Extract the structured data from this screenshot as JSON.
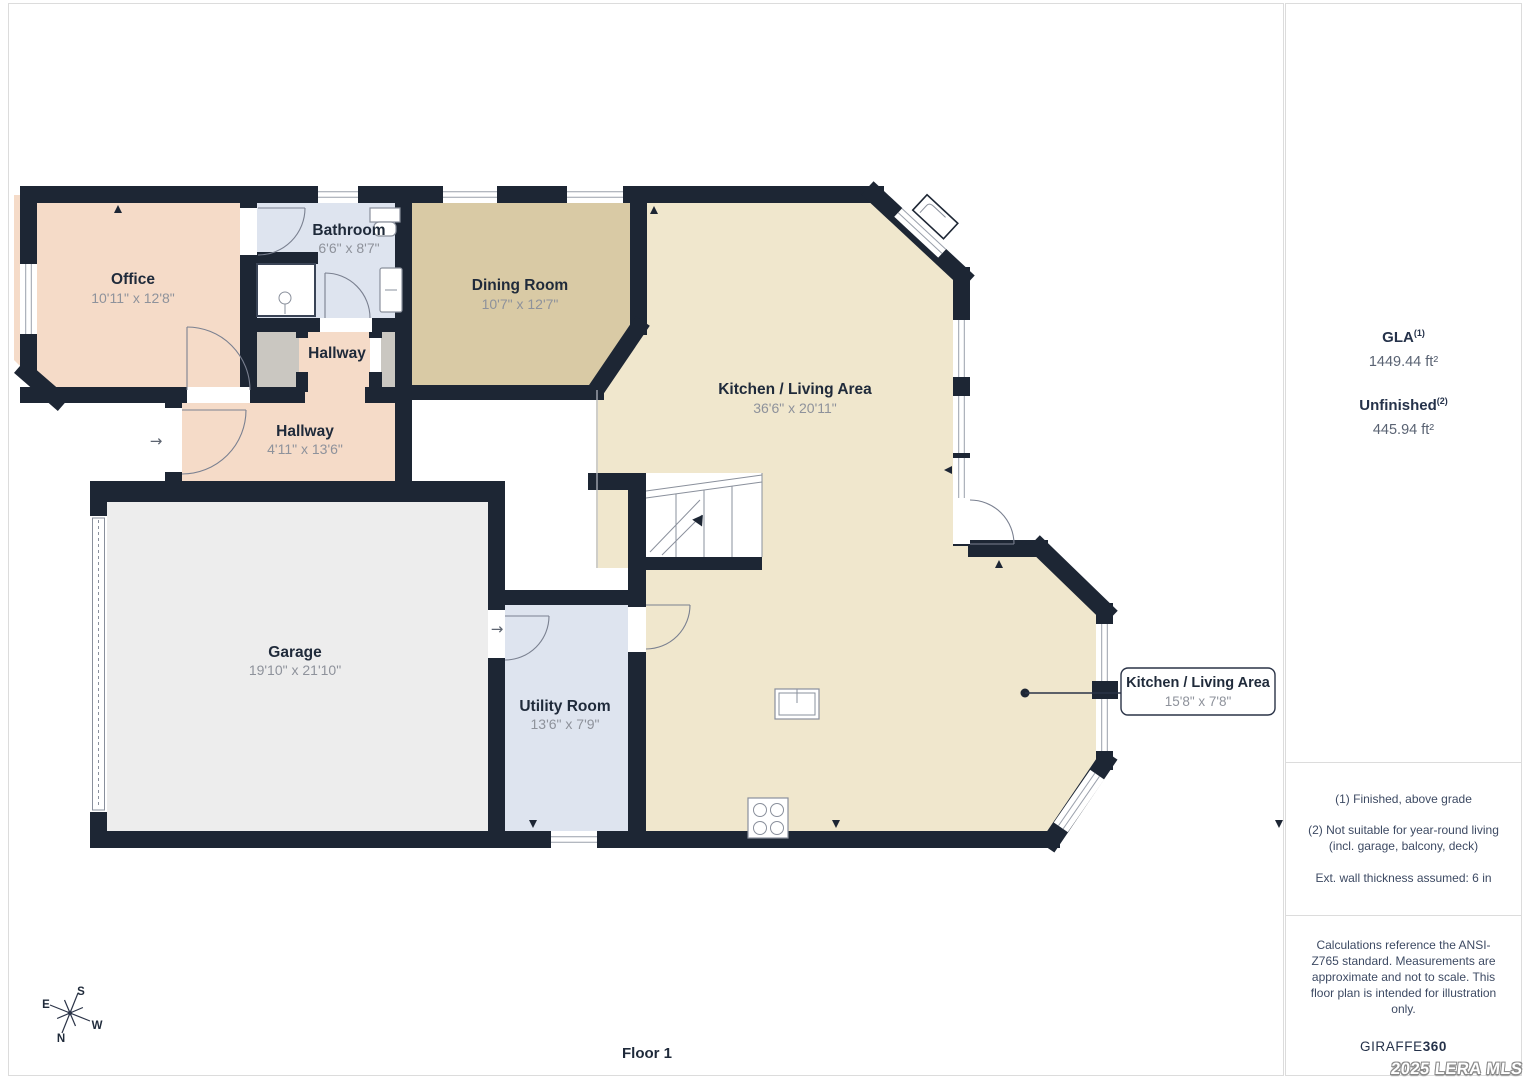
{
  "colors": {
    "wall": "#1d2634",
    "floor_pink": "#f5dbc8",
    "floor_blue": "#dee4ef",
    "floor_grey": "#cac7c1",
    "floor_dining": "#d9caa5",
    "floor_kitchen": "#f0e7cd",
    "floor_garage": "#ededed",
    "label": "#1f2a3a",
    "dims": "#8e929b",
    "border": "#dcdcdc"
  },
  "rooms": {
    "office": {
      "name": "Office",
      "dims": "10'11\" x 12'8\""
    },
    "bathroom": {
      "name": "Bathroom",
      "dims": "6'6\" x 8'7\""
    },
    "hallway_upper": {
      "name": "Hallway"
    },
    "hallway": {
      "name": "Hallway",
      "dims": "4'11\" x 13'6\""
    },
    "dining": {
      "name": "Dining Room",
      "dims": "10'7\" x 12'7\""
    },
    "kitchen": {
      "name": "Kitchen / Living Area",
      "dims": "36'6\" x 20'11\""
    },
    "garage": {
      "name": "Garage",
      "dims": "19'10\" x 21'10\""
    },
    "utility": {
      "name": "Utility Room",
      "dims": "13'6\" x 7'9\""
    }
  },
  "callout": {
    "name": "Kitchen / Living Area",
    "dims": "15'8\" x 7'8\""
  },
  "compass": {
    "n": "N",
    "s": "S",
    "e": "E",
    "w": "W"
  },
  "icons": {
    "entry_arrow": "→",
    "utility_arrow": "→"
  },
  "floor_label": "Floor 1",
  "panel": {
    "gla_label": "GLA",
    "gla_sup": "(1)",
    "gla_value": "1449.44 ft²",
    "unfinished_label": "Unfinished",
    "unfinished_sup": "(2)",
    "unfinished_value": "445.94 ft²",
    "note_1": "(1) Finished, above grade",
    "note_2": "(2) Not suitable for year-round living (incl. garage, balcony, deck)",
    "note_3": "Ext. wall thickness assumed: 6 in",
    "disclaimer": "Calculations reference the ANSI-Z765 standard. Measurements are approximate and not to scale. This floor plan is intended for illustration only.",
    "brand": "GIRAFFE",
    "brand_suffix": "360"
  },
  "watermark": "2025 LERA MLS"
}
